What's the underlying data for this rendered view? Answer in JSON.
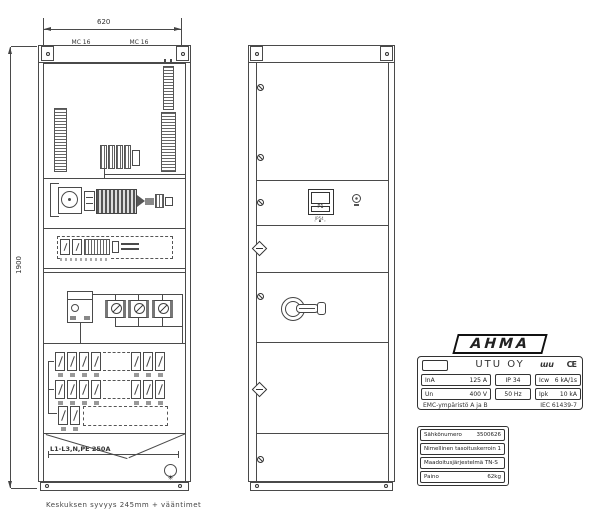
{
  "dimensions": {
    "width": "620",
    "height": "1900"
  },
  "footer_note": "Keskuksen syvyys 245mm + vääntimet",
  "panel": {
    "tag_left_line1": "MC 16",
    "tag_left_line2": "HTC-3",
    "tag_right_line1": "MC 16",
    "tag_right_line2": "HTKC 36",
    "busbar_label": "L1-L3,N,PE 250A",
    "fixing_symbol": "✳"
  },
  "door": {
    "meter_title": "P1",
    "meter_buttons": "‹ ▪ ›",
    "meter_sub": "IP54"
  },
  "nameplate": {
    "brand": "AHMA",
    "company": "UTU OY",
    "utu_mark": "ɯu",
    "ce_mark": "CE",
    "spec": {
      "r1c1_label": "InA",
      "r1c1_value": "125 A",
      "r1c2": "IP 34",
      "r1c3_label": "Icw",
      "r1c3_value": "6 kA/1s",
      "r2c1_label": "Un",
      "r2c1_value": "400 V",
      "r2c2": "50 Hz",
      "r2c3_label": "Ipk",
      "r2c3_value": "10 kA",
      "footer_left": "EMC-ympäristö  A ja B",
      "footer_right": "IEC 61439-7"
    },
    "info_rows": [
      {
        "label": "Sähkönumero",
        "value": "3500626"
      },
      {
        "label": "Nimellinen tasoituskerroin",
        "value": "1"
      },
      {
        "label": "Maadoitusjärjestelmä TN-S",
        "value": ""
      },
      {
        "label": "Paino",
        "value": "62kg"
      }
    ]
  }
}
